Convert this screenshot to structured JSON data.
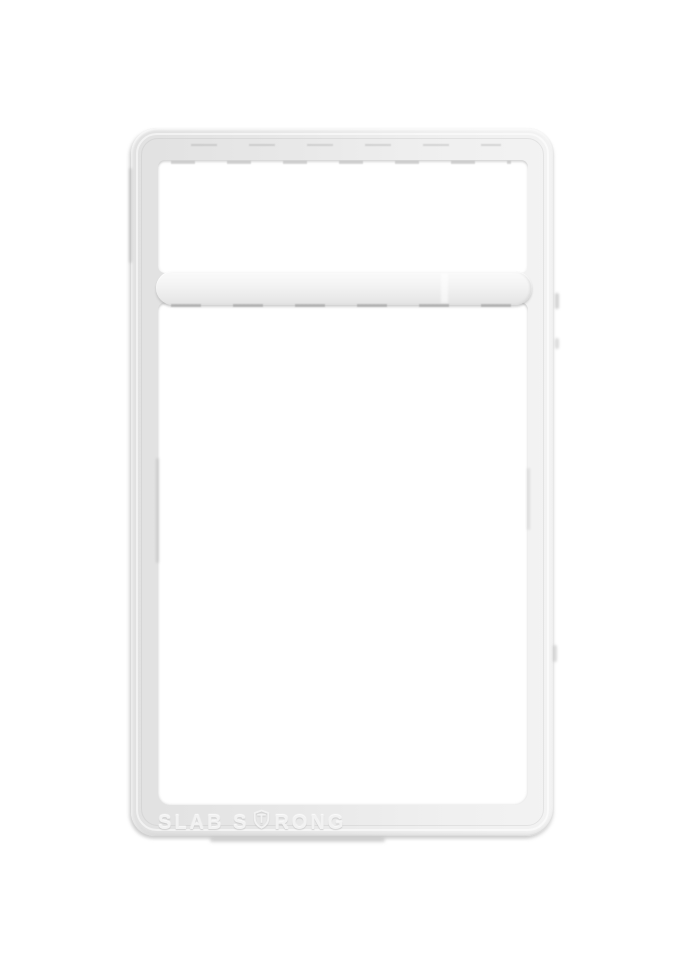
{
  "scene": {
    "type": "product-photo",
    "subject": "Translucent white plastic graded-card slab frame shell",
    "background_color": "#ffffff"
  },
  "slab": {
    "emboss": {
      "full_text": "SLAB STRONG",
      "left_text": "SLAB S",
      "right_text": "RONG",
      "icon": "shield-t-icon"
    },
    "parts": {
      "label_window": "empty top label opening",
      "main_window": "empty card opening",
      "divider_bar": "horizontal cross-bar between label and card openings"
    },
    "colors": {
      "plastic_base": "#e9e9e9",
      "plastic_highlight": "#f7f7f7",
      "plastic_shadow": "#b9b9b9",
      "edge_line": "#cfcfcf",
      "emboss_text": "#f2f2f2"
    }
  }
}
